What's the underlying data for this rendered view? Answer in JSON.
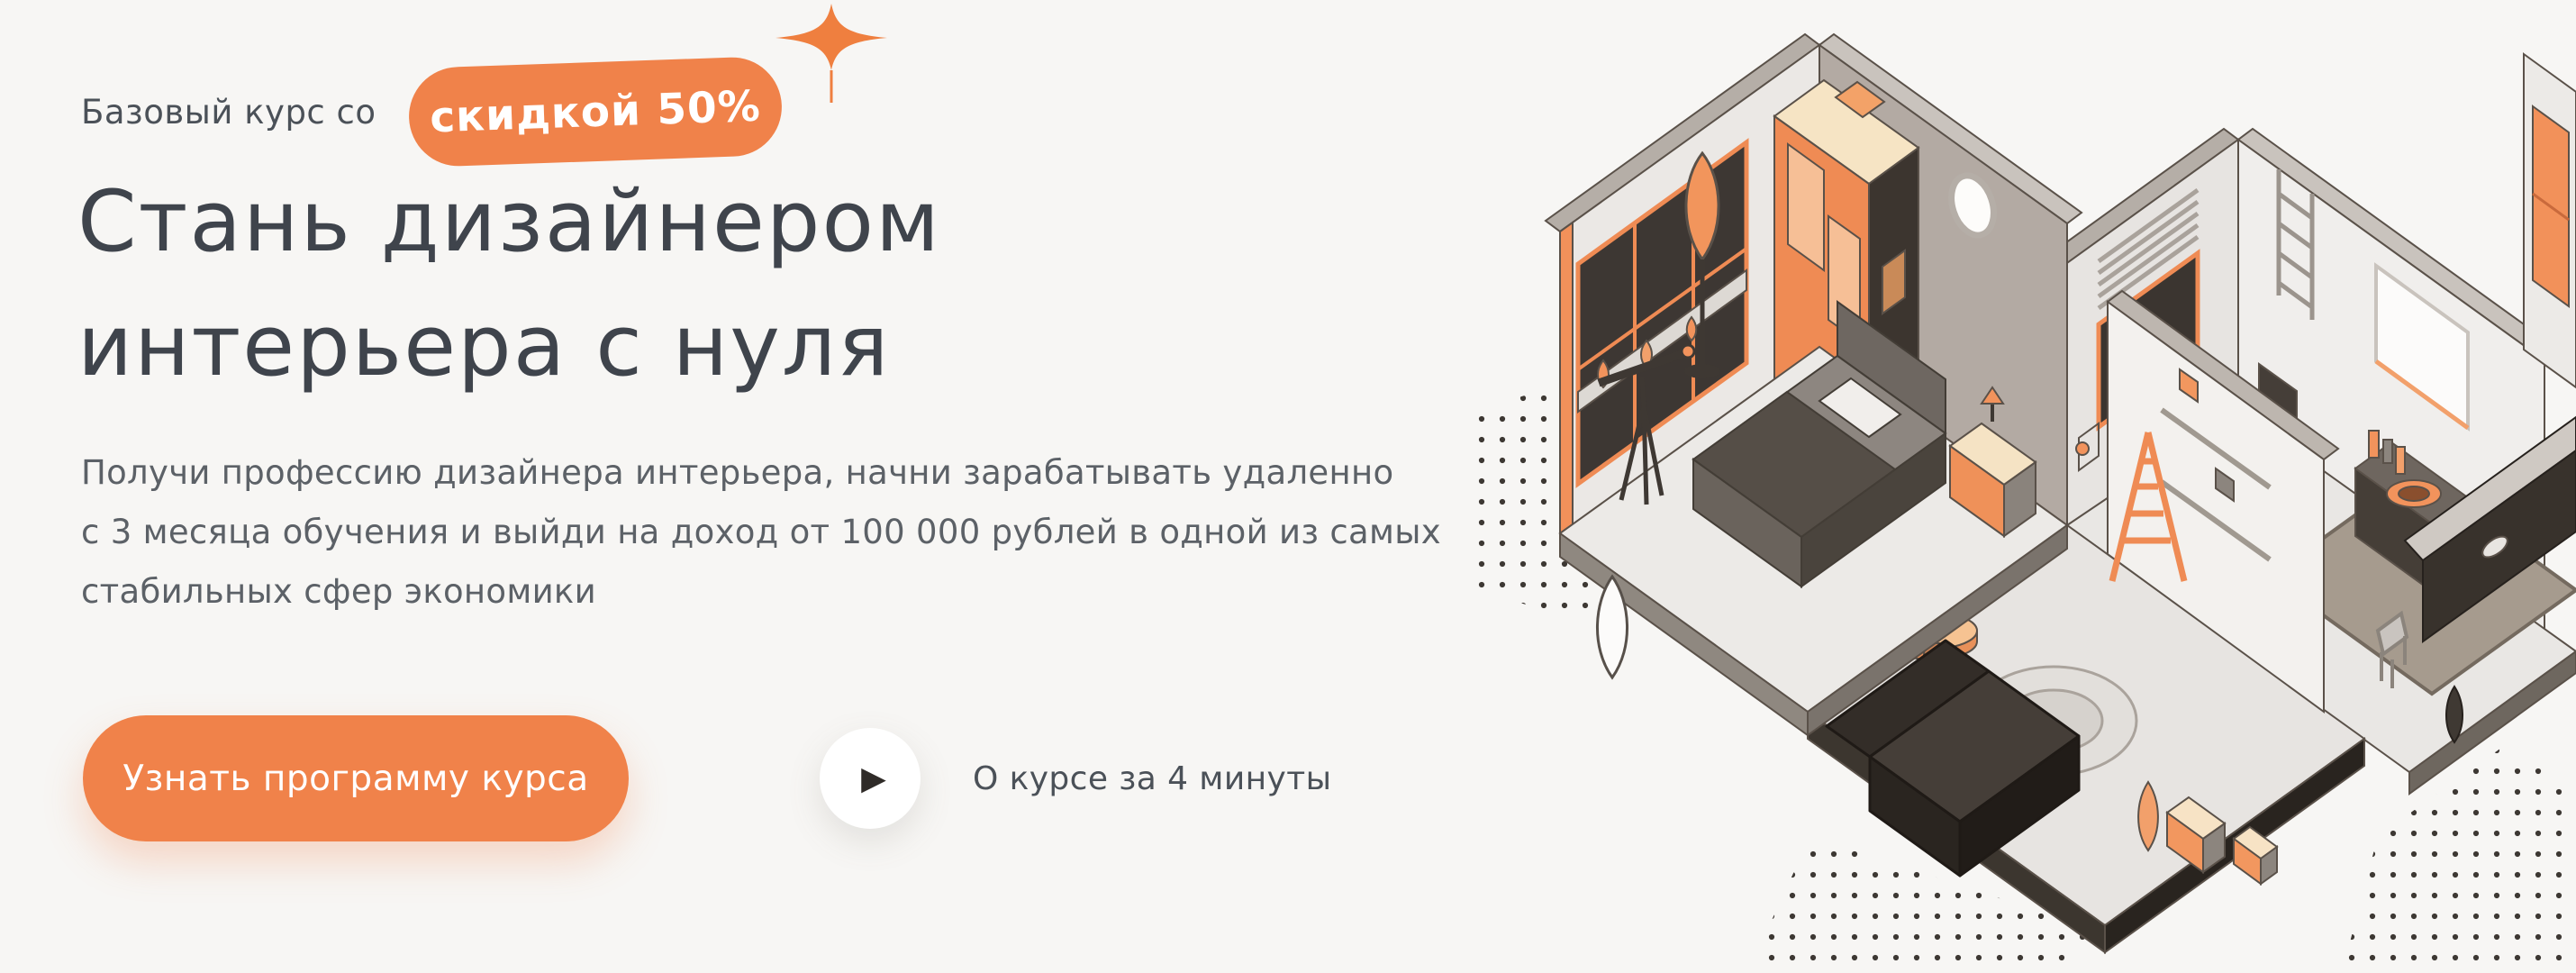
{
  "theme": {
    "background": "#f7f6f4",
    "accent_orange": "#f0824a",
    "heading_color": "#3f444c",
    "body_text_color": "#5c6167"
  },
  "hero": {
    "eyebrow": "Базовый курс со",
    "discount_badge": "скидкой 50%",
    "title_lines": [
      "Стань дизайнером",
      "интерьера с нуля"
    ],
    "description_lines": [
      "Получи профессию дизайнера интерьера, начни зарабатывать удаленно",
      "с 3 месяца обучения и выйди на доход от 100 000 рублей в одной из самых",
      "стабильных сфер экономики"
    ],
    "cta_button": "Узнать программу курса",
    "video_caption": "О курсе за 4 минуты",
    "icons": {
      "play_glyph": "▶",
      "sparkle": "sparkle-icon"
    }
  },
  "illustration": {
    "name": "isometric-apartment-interior",
    "description": "Isometric cutaway of an apartment: bedroom with orange wardrobe, window and bed; bathroom with sink, mirror and toilet; hall with dark sofa, round rug, pedestal table, ladder, boxes and plants; halftone dot patches on edges"
  }
}
